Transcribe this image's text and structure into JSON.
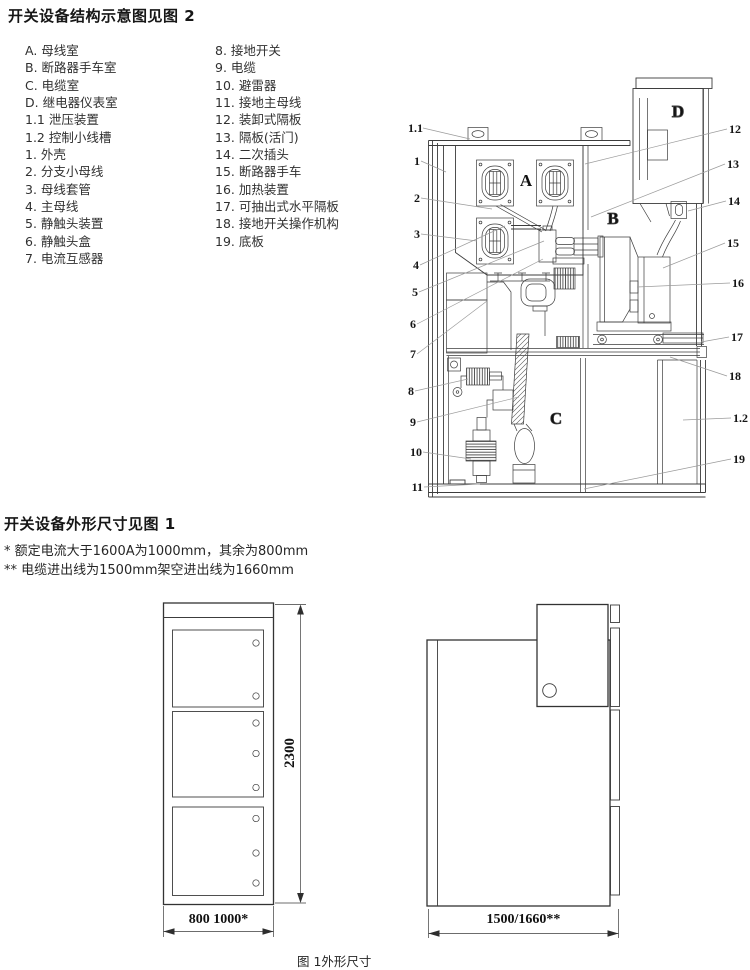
{
  "page": {
    "fig2_title": "开关设备结构示意图见图 2",
    "fig1_title": "开关设备外形尺寸见图 1",
    "footnotes": [
      "* 额定电流大于1600A为1000mm，其余为800mm",
      "** 电缆进出线为1500mm架空进出线为1660mm"
    ],
    "fig1_caption": "图 1外形尺寸"
  },
  "legend": {
    "col1": [
      "A. 母线室",
      "B. 断路器手车室",
      "C. 电缆室",
      "D. 继电器仪表室",
      "1.1 泄压装置",
      "1.2 控制小线槽",
      "1. 外壳",
      "2. 分支小母线",
      "3. 母线套管",
      "4. 主母线",
      "5. 静触头装置",
      "6. 静触头盒",
      "7. 电流互感器"
    ],
    "col2": [
      "8. 接地开关",
      "9. 电缆",
      "10. 避雷器",
      "11. 接地主母线",
      "12. 装卸式隔板",
      "13. 隔板(活门)",
      "14. 二次插头",
      "15. 断路器手车",
      "16. 加热装置",
      "17. 可抽出式水平隔板",
      "18. 接地开关操作机构",
      "19. 底板"
    ]
  },
  "diagram": {
    "labels": {
      "A": "A",
      "B": "B",
      "C": "C",
      "D": "D"
    },
    "callouts_left": [
      "1.1",
      "1",
      "2",
      "3",
      "4",
      "5",
      "6",
      "7",
      "8",
      "9",
      "10",
      "11"
    ],
    "callouts_right": [
      "12",
      "13",
      "14",
      "15",
      "16",
      "17",
      "18",
      "1.2",
      "19"
    ]
  },
  "dimensions": {
    "height": "2300",
    "width_front": "800  1000*",
    "depth_side": "1500/1660**"
  }
}
